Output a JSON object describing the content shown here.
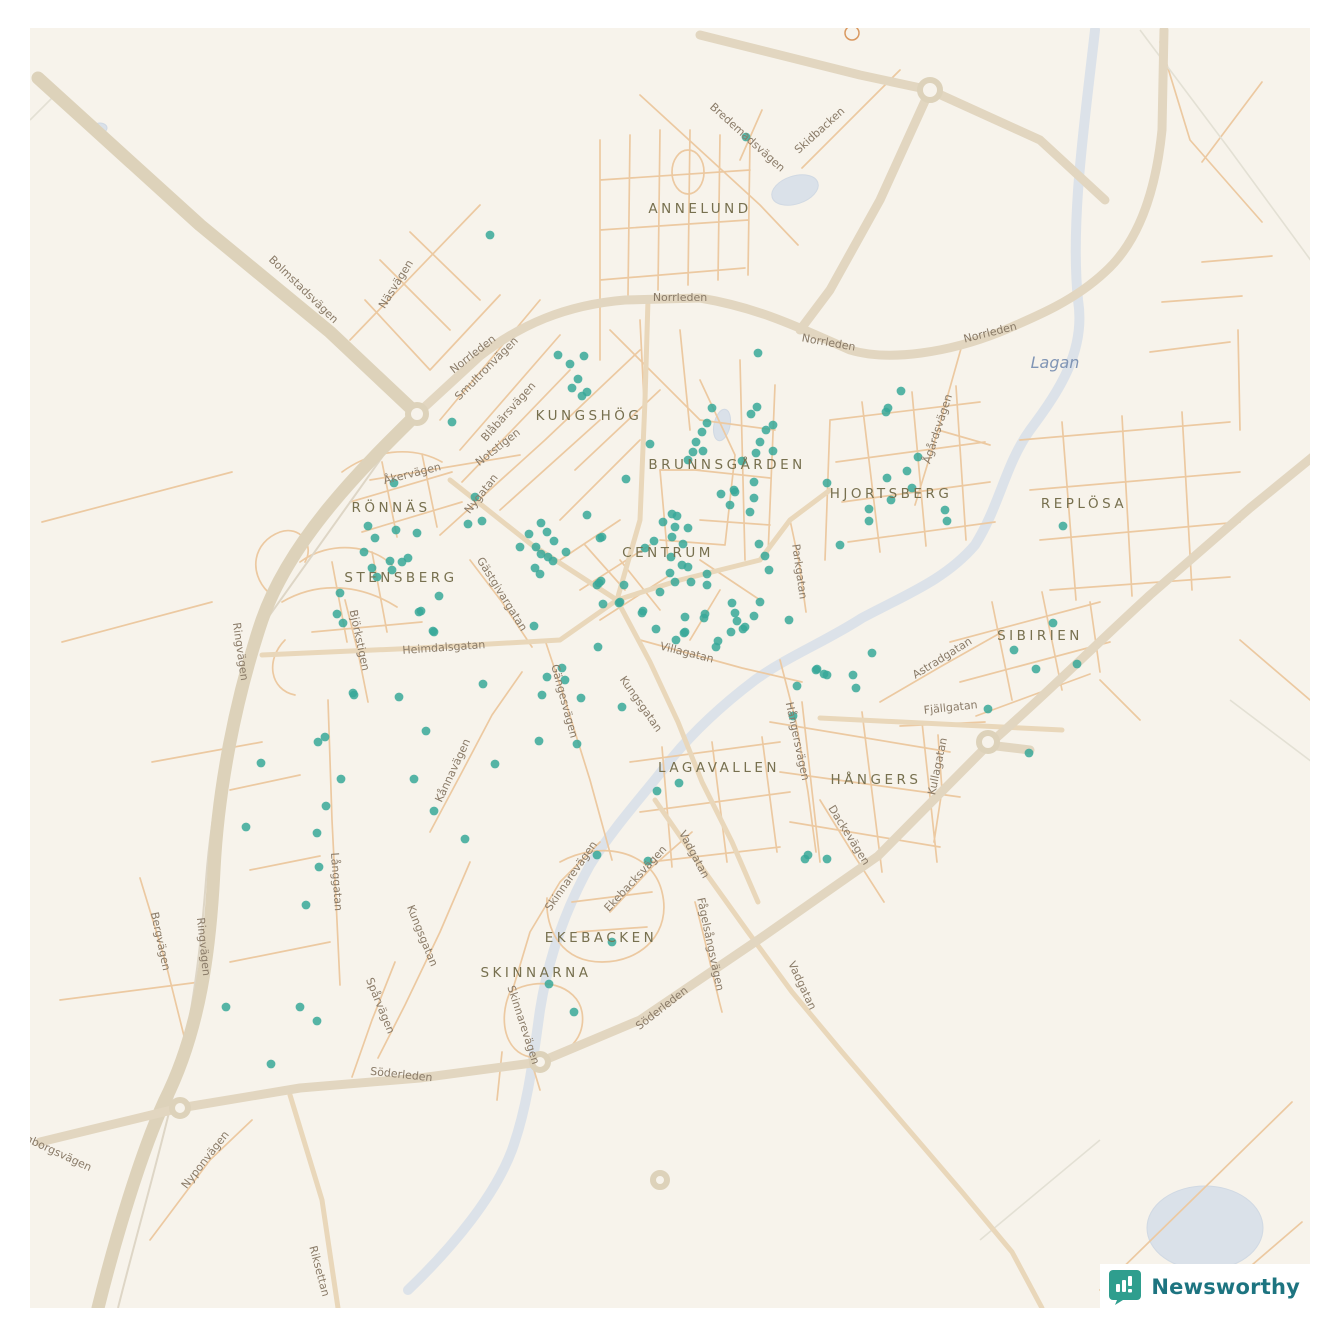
{
  "map": {
    "colors": {
      "background": "#f7f3eb",
      "road_major": "#e2d6c0",
      "road_minor": "#ecc9a1",
      "water": "#d4dde9",
      "district_text": "#77704f",
      "street_text": "#8a7b68",
      "dot": "#38a899",
      "brand_teal": "#1d7480"
    },
    "dot_style": {
      "radius": 4.4,
      "color": "#38a899",
      "opacity": 0.85
    },
    "districts": [
      {
        "label": "ANNELUND",
        "x": 700,
        "y": 213
      },
      {
        "label": "KUNGSHÖG",
        "x": 589,
        "y": 420
      },
      {
        "label": "BRUNNSGÅRDEN",
        "x": 727,
        "y": 469
      },
      {
        "label": "HJORTSBERG",
        "x": 891,
        "y": 498
      },
      {
        "label": "REPLÖSA",
        "x": 1084,
        "y": 508
      },
      {
        "label": "RÖNNÄS",
        "x": 391,
        "y": 512
      },
      {
        "label": "CENTRUM",
        "x": 668,
        "y": 557
      },
      {
        "label": "STENSBERG",
        "x": 401,
        "y": 582
      },
      {
        "label": "SIBIRIEN",
        "x": 1040,
        "y": 640
      },
      {
        "label": "LAGAVALLEN",
        "x": 719,
        "y": 772
      },
      {
        "label": "HÅNGERS",
        "x": 876,
        "y": 784
      },
      {
        "label": "EKEBACKEN",
        "x": 601,
        "y": 942
      },
      {
        "label": "SKINNARNA",
        "x": 536,
        "y": 977
      }
    ],
    "streets": [
      {
        "label": "Bredemadsvägen",
        "x": 745,
        "y": 140,
        "a": 42
      },
      {
        "label": "Skidbacken",
        "x": 822,
        "y": 133,
        "a": -42
      },
      {
        "label": "Norrleden",
        "x": 680,
        "y": 301,
        "a": 0
      },
      {
        "label": "Norrleden",
        "x": 475,
        "y": 357,
        "a": -38
      },
      {
        "label": "Norrleden",
        "x": 828,
        "y": 346,
        "a": 10
      },
      {
        "label": "Norrleden",
        "x": 991,
        "y": 336,
        "a": -14
      },
      {
        "label": "Bolmstadsvägen",
        "x": 301,
        "y": 292,
        "a": 44
      },
      {
        "label": "Näsvägen",
        "x": 399,
        "y": 286,
        "a": -58
      },
      {
        "label": "Smultronvägen",
        "x": 489,
        "y": 371,
        "a": -45
      },
      {
        "label": "Blåbärsvägen",
        "x": 511,
        "y": 414,
        "a": -48
      },
      {
        "label": "Notstigen",
        "x": 500,
        "y": 450,
        "a": -38
      },
      {
        "label": "Åkervägen",
        "x": 413,
        "y": 477,
        "a": -14
      },
      {
        "label": "Nygatan",
        "x": 484,
        "y": 496,
        "a": -52
      },
      {
        "label": "Gästgivargatan",
        "x": 499,
        "y": 596,
        "a": 58
      },
      {
        "label": "Björkstigen",
        "x": 356,
        "y": 641,
        "a": 78
      },
      {
        "label": "Heimdalsgatan",
        "x": 444,
        "y": 651,
        "a": -4
      },
      {
        "label": "Ringvägen",
        "x": 237,
        "y": 652,
        "a": 82
      },
      {
        "label": "Ringvägen",
        "x": 200,
        "y": 947,
        "a": 84
      },
      {
        "label": "Bergvägen",
        "x": 157,
        "y": 942,
        "a": 78
      },
      {
        "label": "Långgatan",
        "x": 333,
        "y": 882,
        "a": 86
      },
      {
        "label": "Kungsgatan",
        "x": 419,
        "y": 937,
        "a": 68
      },
      {
        "label": "Spårvägen",
        "x": 377,
        "y": 1007,
        "a": 68
      },
      {
        "label": "Nyponvägen",
        "x": 208,
        "y": 1162,
        "a": -52
      },
      {
        "label": "Riksettan",
        "x": 316,
        "y": 1272,
        "a": 75
      },
      {
        "label": "Långborgsvägen",
        "x": 48,
        "y": 1152,
        "a": 25
      },
      {
        "label": "Söderleden",
        "x": 401,
        "y": 1078,
        "a": 6
      },
      {
        "label": "Söderleden",
        "x": 664,
        "y": 1011,
        "a": -38
      },
      {
        "label": "Skinnarevägen",
        "x": 574,
        "y": 878,
        "a": -55
      },
      {
        "label": "Skinnarevägen",
        "x": 520,
        "y": 1026,
        "a": 72
      },
      {
        "label": "Ekebacksvägen",
        "x": 638,
        "y": 881,
        "a": -47
      },
      {
        "label": "Vadgatan",
        "x": 691,
        "y": 856,
        "a": 62
      },
      {
        "label": "Vadgatan",
        "x": 799,
        "y": 987,
        "a": 65
      },
      {
        "label": "Fågelsångsvägen",
        "x": 707,
        "y": 945,
        "a": 78
      },
      {
        "label": "Gängesvägen",
        "x": 561,
        "y": 702,
        "a": 75
      },
      {
        "label": "Kungsgatan",
        "x": 638,
        "y": 706,
        "a": 55
      },
      {
        "label": "Villagatan",
        "x": 686,
        "y": 656,
        "a": 14
      },
      {
        "label": "Hångersvägen",
        "x": 794,
        "y": 742,
        "a": 78
      },
      {
        "label": "Parkgatan",
        "x": 796,
        "y": 572,
        "a": 82
      },
      {
        "label": "Ågårdsvägen",
        "x": 941,
        "y": 430,
        "a": -72
      },
      {
        "label": "Astradgatan",
        "x": 944,
        "y": 661,
        "a": -32
      },
      {
        "label": "Fjällgatan",
        "x": 951,
        "y": 711,
        "a": -6
      },
      {
        "label": "Kullagatan",
        "x": 941,
        "y": 767,
        "a": -78
      },
      {
        "label": "Dackevägen",
        "x": 846,
        "y": 837,
        "a": 58
      },
      {
        "label": "Kånnavägen",
        "x": 456,
        "y": 772,
        "a": -65
      }
    ],
    "water_label": {
      "label": "Lagan",
      "x": 1055,
      "y": 368
    },
    "dots": [
      [
        746,
        137
      ],
      [
        490,
        235
      ],
      [
        758,
        353
      ],
      [
        558,
        355
      ],
      [
        584,
        356
      ],
      [
        570,
        364
      ],
      [
        578,
        379
      ],
      [
        572,
        388
      ],
      [
        587,
        392
      ],
      [
        582,
        396
      ],
      [
        452,
        422
      ],
      [
        650,
        444
      ],
      [
        626,
        479
      ],
      [
        712,
        408
      ],
      [
        757,
        407
      ],
      [
        751,
        414
      ],
      [
        773,
        425
      ],
      [
        766,
        430
      ],
      [
        760,
        442
      ],
      [
        756,
        453
      ],
      [
        773,
        451
      ],
      [
        742,
        461
      ],
      [
        707,
        423
      ],
      [
        702,
        432
      ],
      [
        696,
        442
      ],
      [
        693,
        452
      ],
      [
        703,
        451
      ],
      [
        688,
        460
      ],
      [
        735,
        492
      ],
      [
        721,
        494
      ],
      [
        734,
        490
      ],
      [
        730,
        505
      ],
      [
        754,
        498
      ],
      [
        750,
        512
      ],
      [
        827,
        483
      ],
      [
        754,
        482
      ],
      [
        901,
        391
      ],
      [
        886,
        412
      ],
      [
        888,
        408
      ],
      [
        918,
        457
      ],
      [
        907,
        471
      ],
      [
        887,
        478
      ],
      [
        912,
        488
      ],
      [
        891,
        500
      ],
      [
        869,
        509
      ],
      [
        869,
        521
      ],
      [
        945,
        510
      ],
      [
        947,
        521
      ],
      [
        840,
        545
      ],
      [
        1063,
        526
      ],
      [
        1053,
        623
      ],
      [
        1014,
        650
      ],
      [
        1036,
        669
      ],
      [
        1077,
        664
      ],
      [
        988,
        709
      ],
      [
        1029,
        753
      ],
      [
        672,
        514
      ],
      [
        677,
        516
      ],
      [
        663,
        522
      ],
      [
        675,
        527
      ],
      [
        688,
        528
      ],
      [
        672,
        537
      ],
      [
        683,
        544
      ],
      [
        645,
        548
      ],
      [
        602,
        537
      ],
      [
        654,
        541
      ],
      [
        671,
        557
      ],
      [
        682,
        565
      ],
      [
        670,
        573
      ],
      [
        688,
        567
      ],
      [
        691,
        582
      ],
      [
        707,
        574
      ],
      [
        675,
        582
      ],
      [
        707,
        585
      ],
      [
        660,
        592
      ],
      [
        601,
        581
      ],
      [
        620,
        602
      ],
      [
        643,
        611
      ],
      [
        656,
        629
      ],
      [
        684,
        633
      ],
      [
        704,
        618
      ],
      [
        718,
        641
      ],
      [
        732,
        603
      ],
      [
        735,
        613
      ],
      [
        737,
        621
      ],
      [
        731,
        632
      ],
      [
        754,
        616
      ],
      [
        760,
        602
      ],
      [
        743,
        629
      ],
      [
        759,
        544
      ],
      [
        765,
        556
      ],
      [
        769,
        570
      ],
      [
        789,
        620
      ],
      [
        817,
        669
      ],
      [
        827,
        675
      ],
      [
        394,
        483
      ],
      [
        368,
        526
      ],
      [
        396,
        530
      ],
      [
        375,
        538
      ],
      [
        417,
        533
      ],
      [
        364,
        552
      ],
      [
        390,
        561
      ],
      [
        402,
        562
      ],
      [
        408,
        558
      ],
      [
        372,
        568
      ],
      [
        392,
        570
      ],
      [
        377,
        577
      ],
      [
        340,
        593
      ],
      [
        337,
        614
      ],
      [
        343,
        623
      ],
      [
        439,
        596
      ],
      [
        421,
        611
      ],
      [
        433,
        631
      ],
      [
        475,
        497
      ],
      [
        482,
        521
      ],
      [
        468,
        524
      ],
      [
        520,
        547
      ],
      [
        529,
        534
      ],
      [
        536,
        547
      ],
      [
        541,
        554
      ],
      [
        548,
        557
      ],
      [
        553,
        561
      ],
      [
        541,
        523
      ],
      [
        547,
        532
      ],
      [
        554,
        541
      ],
      [
        566,
        552
      ],
      [
        535,
        568
      ],
      [
        540,
        574
      ],
      [
        600,
        538
      ],
      [
        587,
        515
      ],
      [
        597,
        585
      ],
      [
        603,
        604
      ],
      [
        598,
        647
      ],
      [
        534,
        626
      ],
      [
        562,
        668
      ],
      [
        547,
        677
      ],
      [
        565,
        680
      ],
      [
        542,
        695
      ],
      [
        399,
        697
      ],
      [
        353,
        693
      ],
      [
        581,
        698
      ],
      [
        539,
        741
      ],
      [
        577,
        744
      ],
      [
        622,
        707
      ],
      [
        599,
        583
      ],
      [
        619,
        603
      ],
      [
        624,
        585
      ],
      [
        642,
        613
      ],
      [
        676,
        640
      ],
      [
        685,
        632
      ],
      [
        685,
        617
      ],
      [
        705,
        614
      ],
      [
        745,
        627
      ],
      [
        716,
        647
      ],
      [
        657,
        791
      ],
      [
        419,
        612
      ],
      [
        434,
        632
      ],
      [
        354,
        695
      ],
      [
        483,
        684
      ],
      [
        426,
        731
      ],
      [
        318,
        742
      ],
      [
        325,
        737
      ],
      [
        261,
        763
      ],
      [
        341,
        779
      ],
      [
        414,
        779
      ],
      [
        495,
        764
      ],
      [
        326,
        806
      ],
      [
        434,
        811
      ],
      [
        246,
        827
      ],
      [
        317,
        833
      ],
      [
        465,
        839
      ],
      [
        319,
        867
      ],
      [
        872,
        653
      ],
      [
        816,
        670
      ],
      [
        824,
        674
      ],
      [
        853,
        675
      ],
      [
        856,
        688
      ],
      [
        797,
        686
      ],
      [
        793,
        716
      ],
      [
        679,
        783
      ],
      [
        808,
        855
      ],
      [
        805,
        859
      ],
      [
        827,
        859
      ],
      [
        597,
        855
      ],
      [
        648,
        861
      ],
      [
        612,
        942
      ],
      [
        549,
        984
      ],
      [
        574,
        1012
      ],
      [
        306,
        905
      ],
      [
        226,
        1007
      ],
      [
        300,
        1007
      ],
      [
        317,
        1021
      ],
      [
        271,
        1064
      ]
    ]
  },
  "footer": {
    "brand": "Newsworthy"
  }
}
